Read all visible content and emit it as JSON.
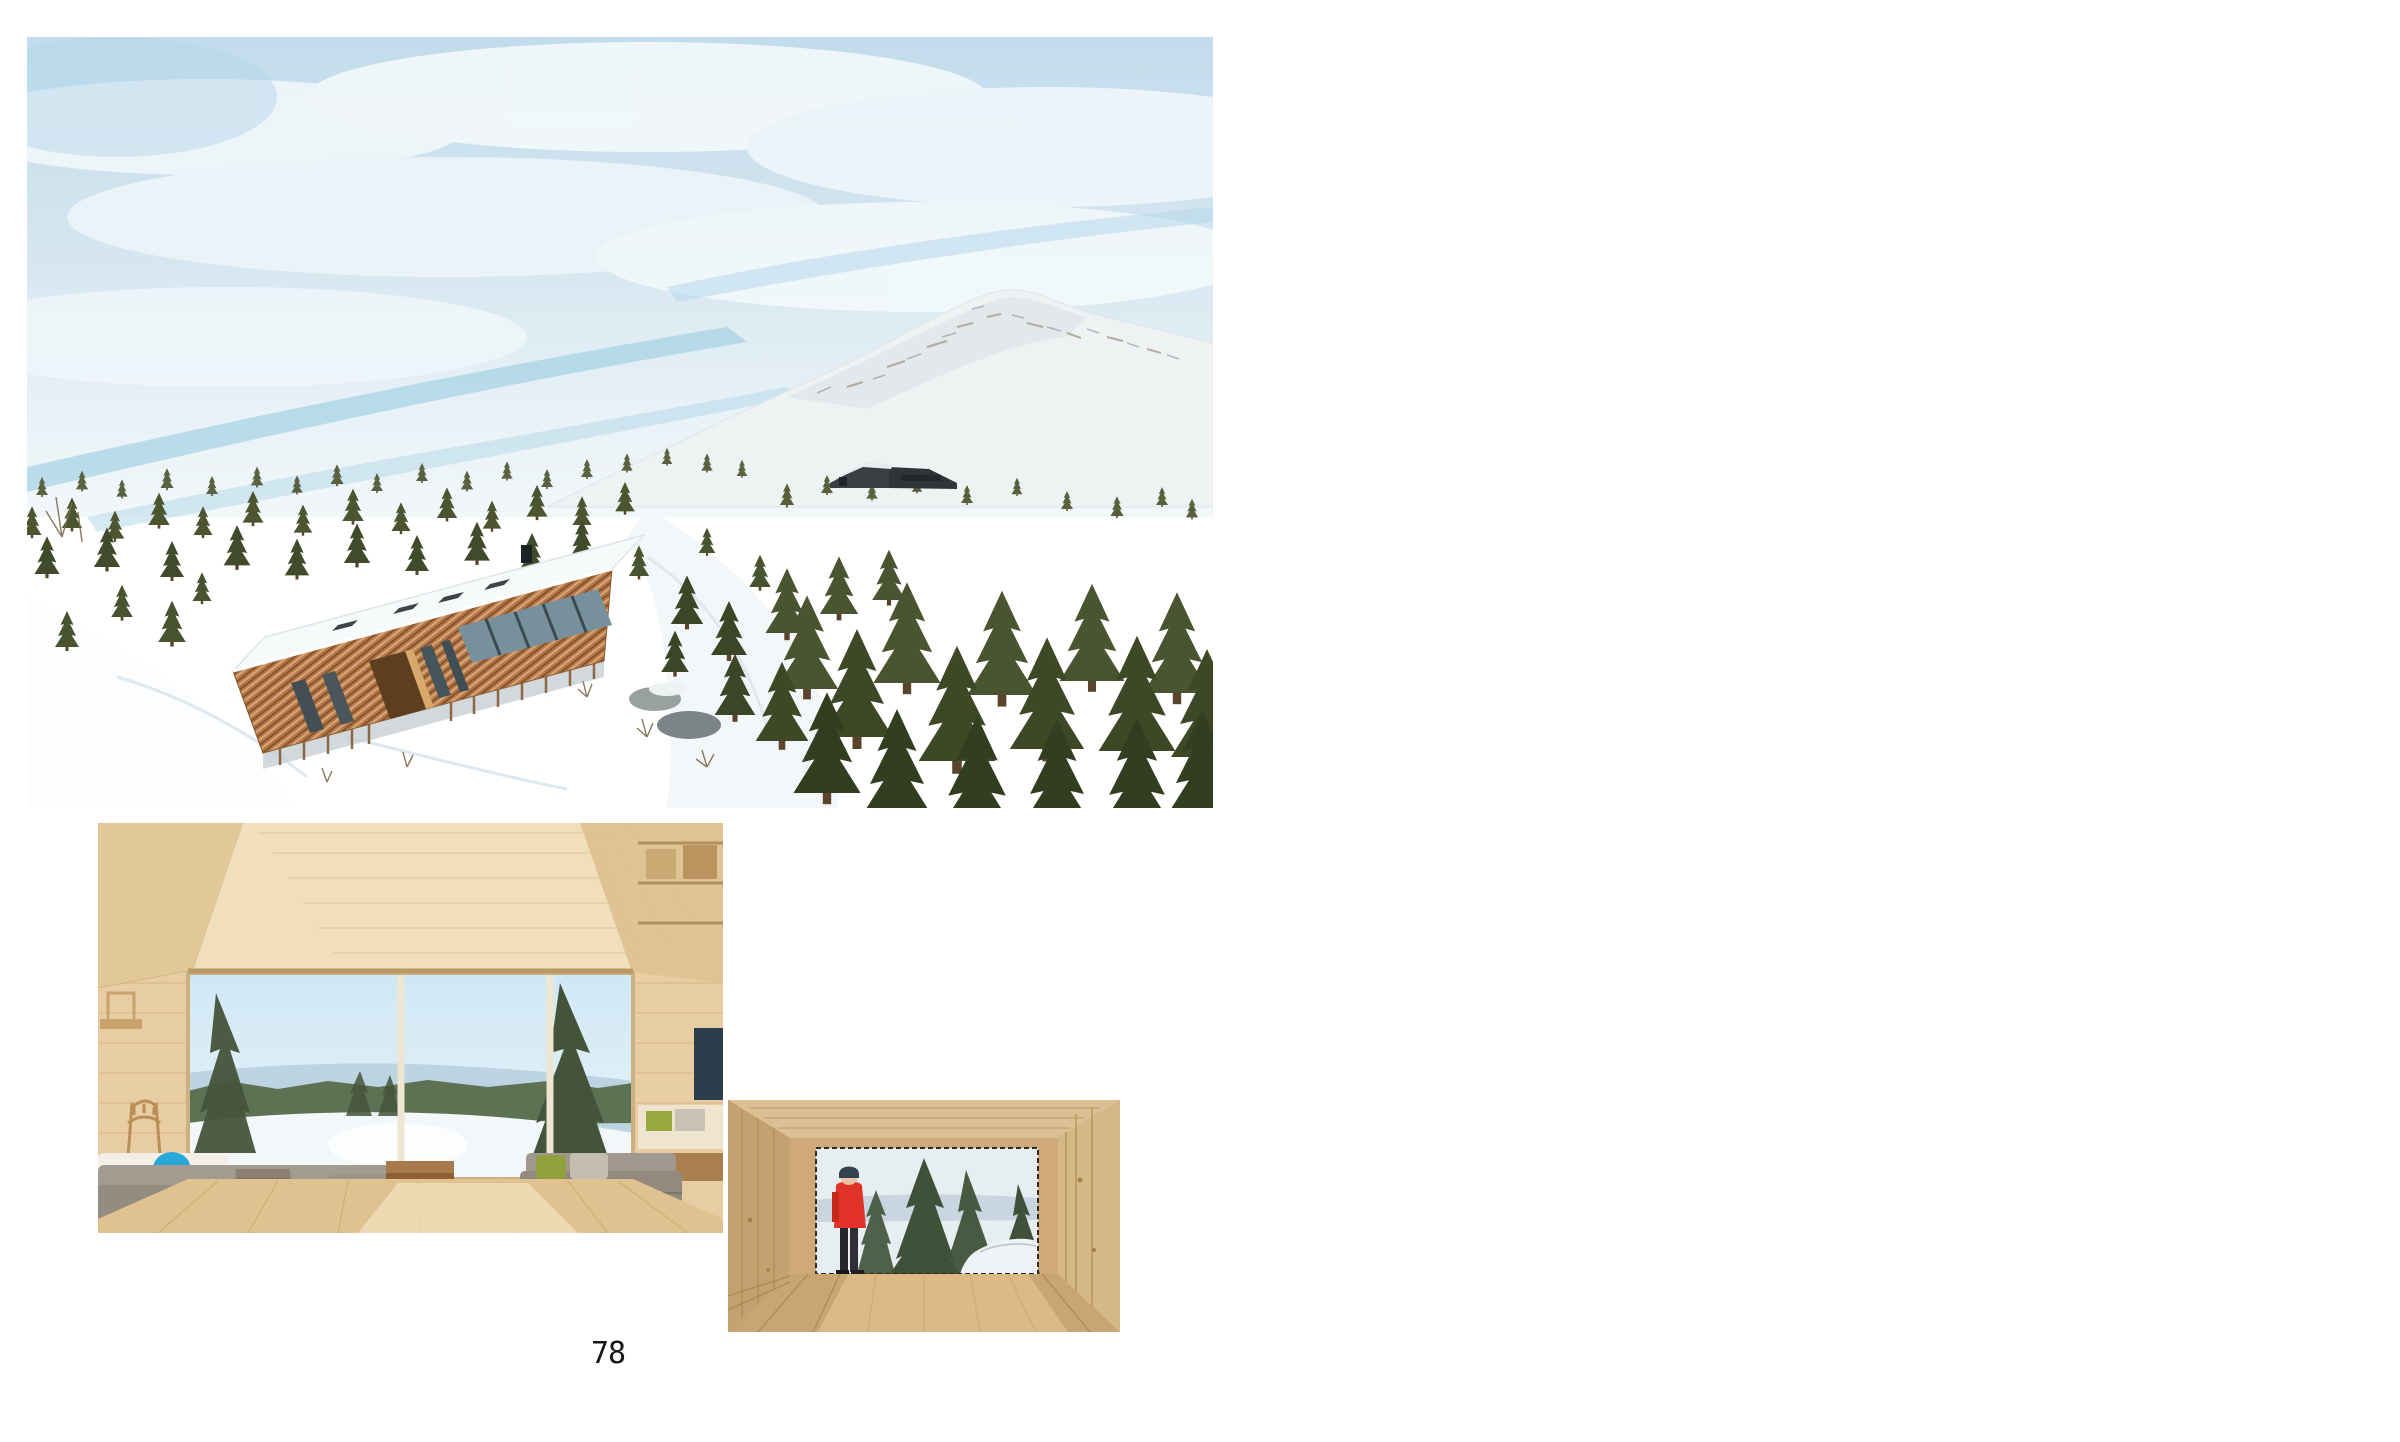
{
  "left_page": {
    "page_number": "78"
  },
  "right_page": {
    "page_number": "79",
    "body_text": "On top of a mountain in Kvitfjell resort of Fåvang, Norway,\nis a regular grid of 45 wooden columns. The columns lift\na 144-square- meter cabin 1.5 meters above the ground,\nallowing native grasses that sheep and cows graze on to\ngrow below. The columns are clad with skigard, a long\nand narrow, quarter cut tree log that is traditionally laid\nout diagonally by Norwegian farmers as fencing. The roof\nis overgrown with the same native grasses found on the\nground below and on century's old Norwegian buildings.\nThe cabin is accessed through a series of wide wooden\nsteps that lead to a veranda which frames the view of\na valley and river below. Internally, the wood cabin is\ndivided along its length into four smaller spaces, each\nhoused under a frustrum ceiling capped with a skylight.\nThe spaces are scaled intimately but open visually and\nphysically to the landscape below and a small grove of\ntrees the cabin is nestled in."
  },
  "palette": {
    "paper": "#ffffff",
    "ink": "#1a1a1a",
    "diagram_panel": "#f3f3f1",
    "grass_green": "#93b989",
    "dark_volume": "#474540",
    "cabin_wood": "#b5774a",
    "jacket_red": "#e03226"
  }
}
